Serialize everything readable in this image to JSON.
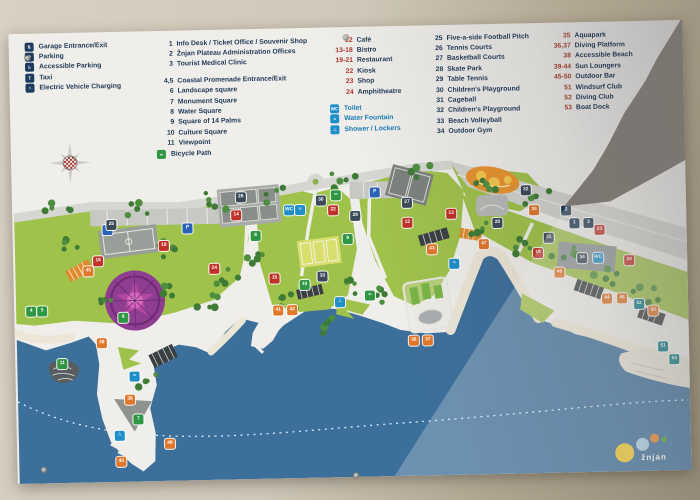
{
  "legend": {
    "facilities": [
      {
        "icon": "garage-icon",
        "glyph": "⇅",
        "label": "Garage Entrance/Exit"
      },
      {
        "icon": "parking-icon",
        "glyph": "P",
        "label": "Parking"
      },
      {
        "icon": "accessible-parking-icon",
        "glyph": "♿",
        "label": "Accessible Parking"
      },
      {
        "icon": "taxi-icon",
        "glyph": "T",
        "label": "Taxi"
      },
      {
        "icon": "ev-charging-icon",
        "glyph": "⚡",
        "label": "Electric Vehicle Charging"
      }
    ],
    "places": [
      {
        "num": "1",
        "label": "Info Desk / Ticket Office / Souvenir Shop"
      },
      {
        "num": "2",
        "label": "Žnjan Plateau Administration Offices"
      },
      {
        "num": "3",
        "label": "Tourist Medical Clinic"
      },
      {
        "num": "4,5",
        "label": "Coastal Promenade Entrance/Exit",
        "gap": true
      },
      {
        "num": "6",
        "label": "Landscape square"
      },
      {
        "num": "7",
        "label": "Monument Square"
      },
      {
        "num": "8",
        "label": "Water Square"
      },
      {
        "num": "9",
        "label": "Square of 14 Palms"
      },
      {
        "num": "10",
        "label": "Culture Square"
      },
      {
        "num": "11",
        "label": "Viewpoint"
      },
      {
        "icon": "bicycle-path-icon",
        "glyph": "∞",
        "label": "Bicycle Path"
      }
    ],
    "food": [
      {
        "num": "12",
        "label": "Café"
      },
      {
        "num": "13-18",
        "label": "Bistro"
      },
      {
        "num": "19-21",
        "label": "Restaurant"
      },
      {
        "num": "22",
        "label": "Kiosk"
      },
      {
        "num": "23",
        "label": "Shop"
      },
      {
        "num": "24",
        "label": "Amphitheatre"
      }
    ],
    "amenities": [
      {
        "icon": "toilet-icon",
        "glyph": "WC",
        "label": "Toilet",
        "gap": true
      },
      {
        "icon": "water-fountain-icon",
        "glyph": "≈",
        "label": "Water Fountain"
      },
      {
        "icon": "shower-lockers-icon",
        "glyph": "∴",
        "label": "Shower / Lockers"
      }
    ],
    "sports": [
      {
        "num": "25",
        "label": "Five-a-side Football Pitch"
      },
      {
        "num": "26",
        "label": "Tennis Courts"
      },
      {
        "num": "27",
        "label": "Basketball Courts"
      },
      {
        "num": "28",
        "label": "Skate Park"
      },
      {
        "num": "29",
        "label": "Table Tennis"
      },
      {
        "num": "30",
        "label": "Children's Playground"
      },
      {
        "num": "31",
        "label": "Cageball"
      },
      {
        "num": "32",
        "label": "Children's Playground"
      },
      {
        "num": "33",
        "label": "Beach Volleyball"
      },
      {
        "num": "34",
        "label": "Outdoor Gym"
      }
    ],
    "beach": [
      {
        "num": "35",
        "label": "Aquapark"
      },
      {
        "num": "36,37",
        "label": "Diving Platform"
      },
      {
        "num": "38",
        "label": "Accessible Beach"
      },
      {
        "num": "39-44",
        "label": "Sun Loungers"
      },
      {
        "num": "45-50",
        "label": "Outdoor Bar"
      },
      {
        "num": "51",
        "label": "Windsurf Club"
      },
      {
        "num": "52",
        "label": "Diving Club"
      },
      {
        "num": "53",
        "label": "Boat Dock"
      }
    ]
  },
  "map": {
    "markers": [
      {
        "n": "P",
        "c": "pblue",
        "x": 90,
        "y": 193
      },
      {
        "n": "P",
        "c": "pblue",
        "x": 170,
        "y": 193
      },
      {
        "n": "P",
        "c": "pblue",
        "x": 358,
        "y": 161
      },
      {
        "n": "1",
        "c": "navy",
        "x": 557,
        "y": 196
      },
      {
        "n": "2",
        "c": "navy",
        "x": 549,
        "y": 183
      },
      {
        "n": "3",
        "c": "navy",
        "x": 571,
        "y": 196
      },
      {
        "n": "4",
        "c": "green",
        "x": 12,
        "y": 273
      },
      {
        "n": "5",
        "c": "green",
        "x": 23,
        "y": 273
      },
      {
        "n": "6",
        "c": "green",
        "x": 104,
        "y": 281
      },
      {
        "n": "7",
        "c": "green",
        "x": 117,
        "y": 383
      },
      {
        "n": "8",
        "c": "green",
        "x": 238,
        "y": 202
      },
      {
        "n": "9",
        "c": "green",
        "x": 330,
        "y": 207
      },
      {
        "n": "10",
        "c": "green",
        "x": 286,
        "y": 252
      },
      {
        "n": "11",
        "c": "green",
        "x": 42,
        "y": 326
      },
      {
        "n": "∞",
        "c": "green",
        "x": 319,
        "y": 163
      },
      {
        "n": "∞",
        "c": "green",
        "x": 351,
        "y": 264
      },
      {
        "n": "12",
        "c": "red",
        "x": 390,
        "y": 192
      },
      {
        "n": "13",
        "c": "red",
        "x": 434,
        "y": 184
      },
      {
        "n": "14",
        "c": "red",
        "x": 219,
        "y": 181
      },
      {
        "n": "15",
        "c": "red",
        "x": 256,
        "y": 245
      },
      {
        "n": "16",
        "c": "red",
        "x": 80,
        "y": 224
      },
      {
        "n": "18",
        "c": "red",
        "x": 520,
        "y": 225
      },
      {
        "n": "19",
        "c": "red",
        "x": 146,
        "y": 210
      },
      {
        "n": "20",
        "c": "red",
        "x": 611,
        "y": 234
      },
      {
        "n": "22",
        "c": "red",
        "x": 316,
        "y": 178
      },
      {
        "n": "23",
        "c": "red",
        "x": 582,
        "y": 203
      },
      {
        "n": "24",
        "c": "red",
        "x": 196,
        "y": 234
      },
      {
        "n": "WC",
        "c": "blue",
        "x": 272,
        "y": 177
      },
      {
        "n": "≈",
        "c": "blue",
        "x": 283,
        "y": 177
      },
      {
        "n": "WC",
        "c": "blue",
        "x": 580,
        "y": 231
      },
      {
        "n": "≈",
        "c": "blue",
        "x": 436,
        "y": 234
      },
      {
        "n": "∴",
        "c": "blue",
        "x": 321,
        "y": 270
      },
      {
        "n": "≈",
        "c": "blue",
        "x": 114,
        "y": 340
      },
      {
        "n": "∴",
        "c": "blue",
        "x": 98,
        "y": 399
      },
      {
        "n": "25",
        "c": "slate",
        "x": 94,
        "y": 188
      },
      {
        "n": "26",
        "c": "slate",
        "x": 224,
        "y": 163
      },
      {
        "n": "27",
        "c": "slate",
        "x": 390,
        "y": 172
      },
      {
        "n": "28",
        "c": "slate",
        "x": 480,
        "y": 194
      },
      {
        "n": "29",
        "c": "slate",
        "x": 338,
        "y": 184
      },
      {
        "n": "30",
        "c": "slate",
        "x": 304,
        "y": 168
      },
      {
        "n": "31",
        "c": "slate",
        "x": 531,
        "y": 210
      },
      {
        "n": "32",
        "c": "slate",
        "x": 509,
        "y": 162
      },
      {
        "n": "33",
        "c": "slate",
        "x": 304,
        "y": 244
      },
      {
        "n": "34",
        "c": "slate",
        "x": 564,
        "y": 231
      },
      {
        "n": "35",
        "c": "orange",
        "x": 517,
        "y": 182
      },
      {
        "n": "36",
        "c": "orange",
        "x": 394,
        "y": 310
      },
      {
        "n": "37",
        "c": "orange",
        "x": 408,
        "y": 310
      },
      {
        "n": "38",
        "c": "orange",
        "x": 82,
        "y": 306
      },
      {
        "n": "39",
        "c": "orange",
        "x": 109,
        "y": 363
      },
      {
        "n": "40",
        "c": "orange",
        "x": 99,
        "y": 425
      },
      {
        "n": "41",
        "c": "orange",
        "x": 259,
        "y": 277
      },
      {
        "n": "42",
        "c": "orange",
        "x": 273,
        "y": 277
      },
      {
        "n": "43",
        "c": "orange",
        "x": 414,
        "y": 219
      },
      {
        "n": "44",
        "c": "orange",
        "x": 588,
        "y": 272
      },
      {
        "n": "45",
        "c": "orange",
        "x": 70,
        "y": 234
      },
      {
        "n": "46",
        "c": "orange",
        "x": 603,
        "y": 272
      },
      {
        "n": "47",
        "c": "orange",
        "x": 466,
        "y": 215
      },
      {
        "n": "48",
        "c": "orange",
        "x": 148,
        "y": 408
      },
      {
        "n": "49",
        "c": "orange",
        "x": 541,
        "y": 245
      },
      {
        "n": "50",
        "c": "orange",
        "x": 634,
        "y": 285
      },
      {
        "n": "51",
        "c": "teal",
        "x": 643,
        "y": 321
      },
      {
        "n": "52",
        "c": "teal",
        "x": 620,
        "y": 278
      },
      {
        "n": "53",
        "c": "teal",
        "x": 654,
        "y": 334
      }
    ]
  },
  "logo": {
    "text": "žnjan"
  },
  "colors": {
    "sea_shaded": "#3d6f9b",
    "park_green": "#9fc24b",
    "tree_green": "#4e8f3f",
    "road_grey": "#d6d6d2",
    "marker_red": "#c03229",
    "marker_orange": "#e0772b",
    "legend_navy": "#223a57",
    "legend_red": "#b2382e",
    "amenity_blue": "#1a7cb4"
  }
}
